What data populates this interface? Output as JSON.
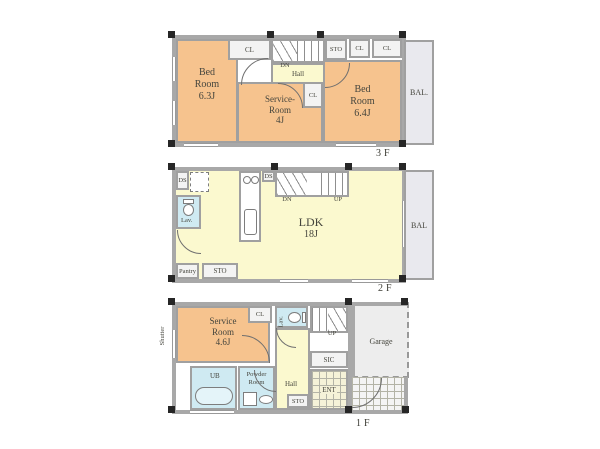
{
  "palette": {
    "room_orange": "#f6c38e",
    "room_yellow": "#fbf9cf",
    "room_blue": "#cfeaf2",
    "wall_gray": "#a8a8a8",
    "garage_gray": "#ededed",
    "balcony_gray": "#e9e9ee"
  },
  "f3": {
    "floor_label": "3F",
    "bedroom1": {
      "l1": "Bed",
      "l2": "Room",
      "l3": "6.3J"
    },
    "closet_left": "CL",
    "stair_dn": "DN",
    "hall": "Hall",
    "storage": "STO",
    "closet_mid": "CL",
    "closet_right": "CL",
    "bedroom2": {
      "l1": "Bed",
      "l2": "Room",
      "l3": "6.4J"
    },
    "service_room": {
      "l1": "Service-",
      "l2": "Room",
      "l3": "4J"
    },
    "service_closet": "CL",
    "balcony": "BAL."
  },
  "f2": {
    "floor_label": "2F",
    "duct_left": "DS",
    "duct_mid": "DS",
    "lavatory": "Lav.",
    "ldk": {
      "l1": "LDK",
      "l2": "18J"
    },
    "stair_dn": "DN",
    "stair_up": "UP",
    "pantry": "Pantry",
    "storage": "STO",
    "balcony": "BAL"
  },
  "f1": {
    "floor_label": "1F",
    "service_room": {
      "l1": "Service",
      "l2": "Room",
      "l3": "4.6J"
    },
    "shutter": "Shutter",
    "closet": "CL",
    "lavatory": "Lav.",
    "stair_up": "UP",
    "garage": "Garage",
    "hall": "Hall",
    "shoe_closet": "SIC",
    "entrance": "ENT",
    "bath": "UB",
    "powder_room": {
      "l1": "Powder",
      "l2": "Room"
    },
    "storage": "STO"
  }
}
